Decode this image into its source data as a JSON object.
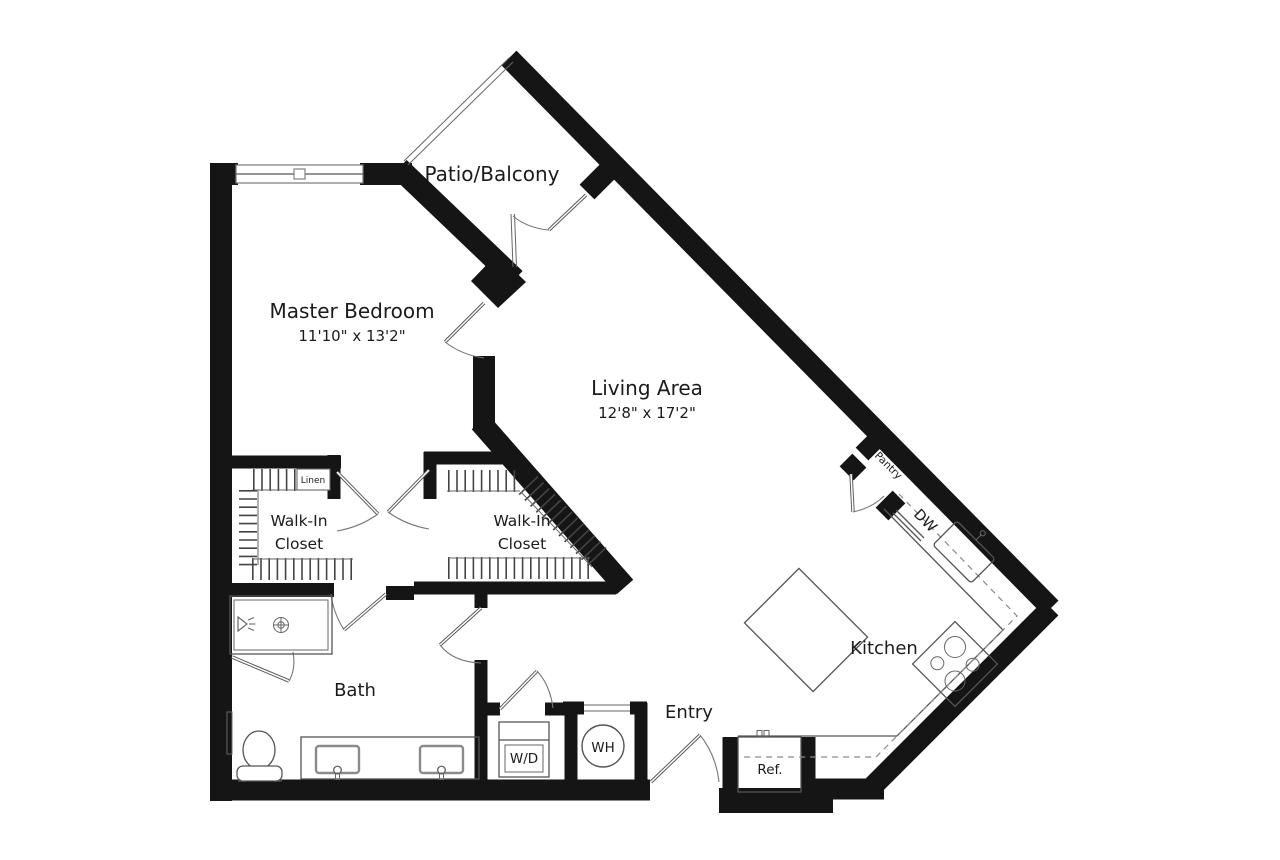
{
  "title": "One-bedroom apartment floor plan",
  "colors": {
    "background": "#ffffff",
    "walls": "#151515",
    "lines": "#555555",
    "hatch": "#444444"
  },
  "rooms": {
    "patio": {
      "label": "Patio/Balcony"
    },
    "master_bedroom": {
      "label": "Master Bedroom",
      "dimensions": "11'10\" x 13'2\""
    },
    "living_area": {
      "label": "Living Area",
      "dimensions": "12'8\" x 17'2\""
    },
    "walk_in_closet_1": {
      "label_line_1": "Walk-In",
      "label_line_2": "Closet"
    },
    "walk_in_closet_2": {
      "label_line_1": "Walk-In",
      "label_line_2": "Closet"
    },
    "linen_closet": {
      "label": "Linen"
    },
    "bath": {
      "label": "Bath"
    },
    "entry": {
      "label": "Entry"
    },
    "kitchen": {
      "label": "Kitchen"
    },
    "pantry": {
      "label": "Pantry"
    }
  },
  "appliances": {
    "washer_dryer": {
      "label": "W/D"
    },
    "water_heater": {
      "label": "WH"
    },
    "refrigerator": {
      "label": "Ref."
    },
    "dishwasher": {
      "label": "DW"
    }
  }
}
